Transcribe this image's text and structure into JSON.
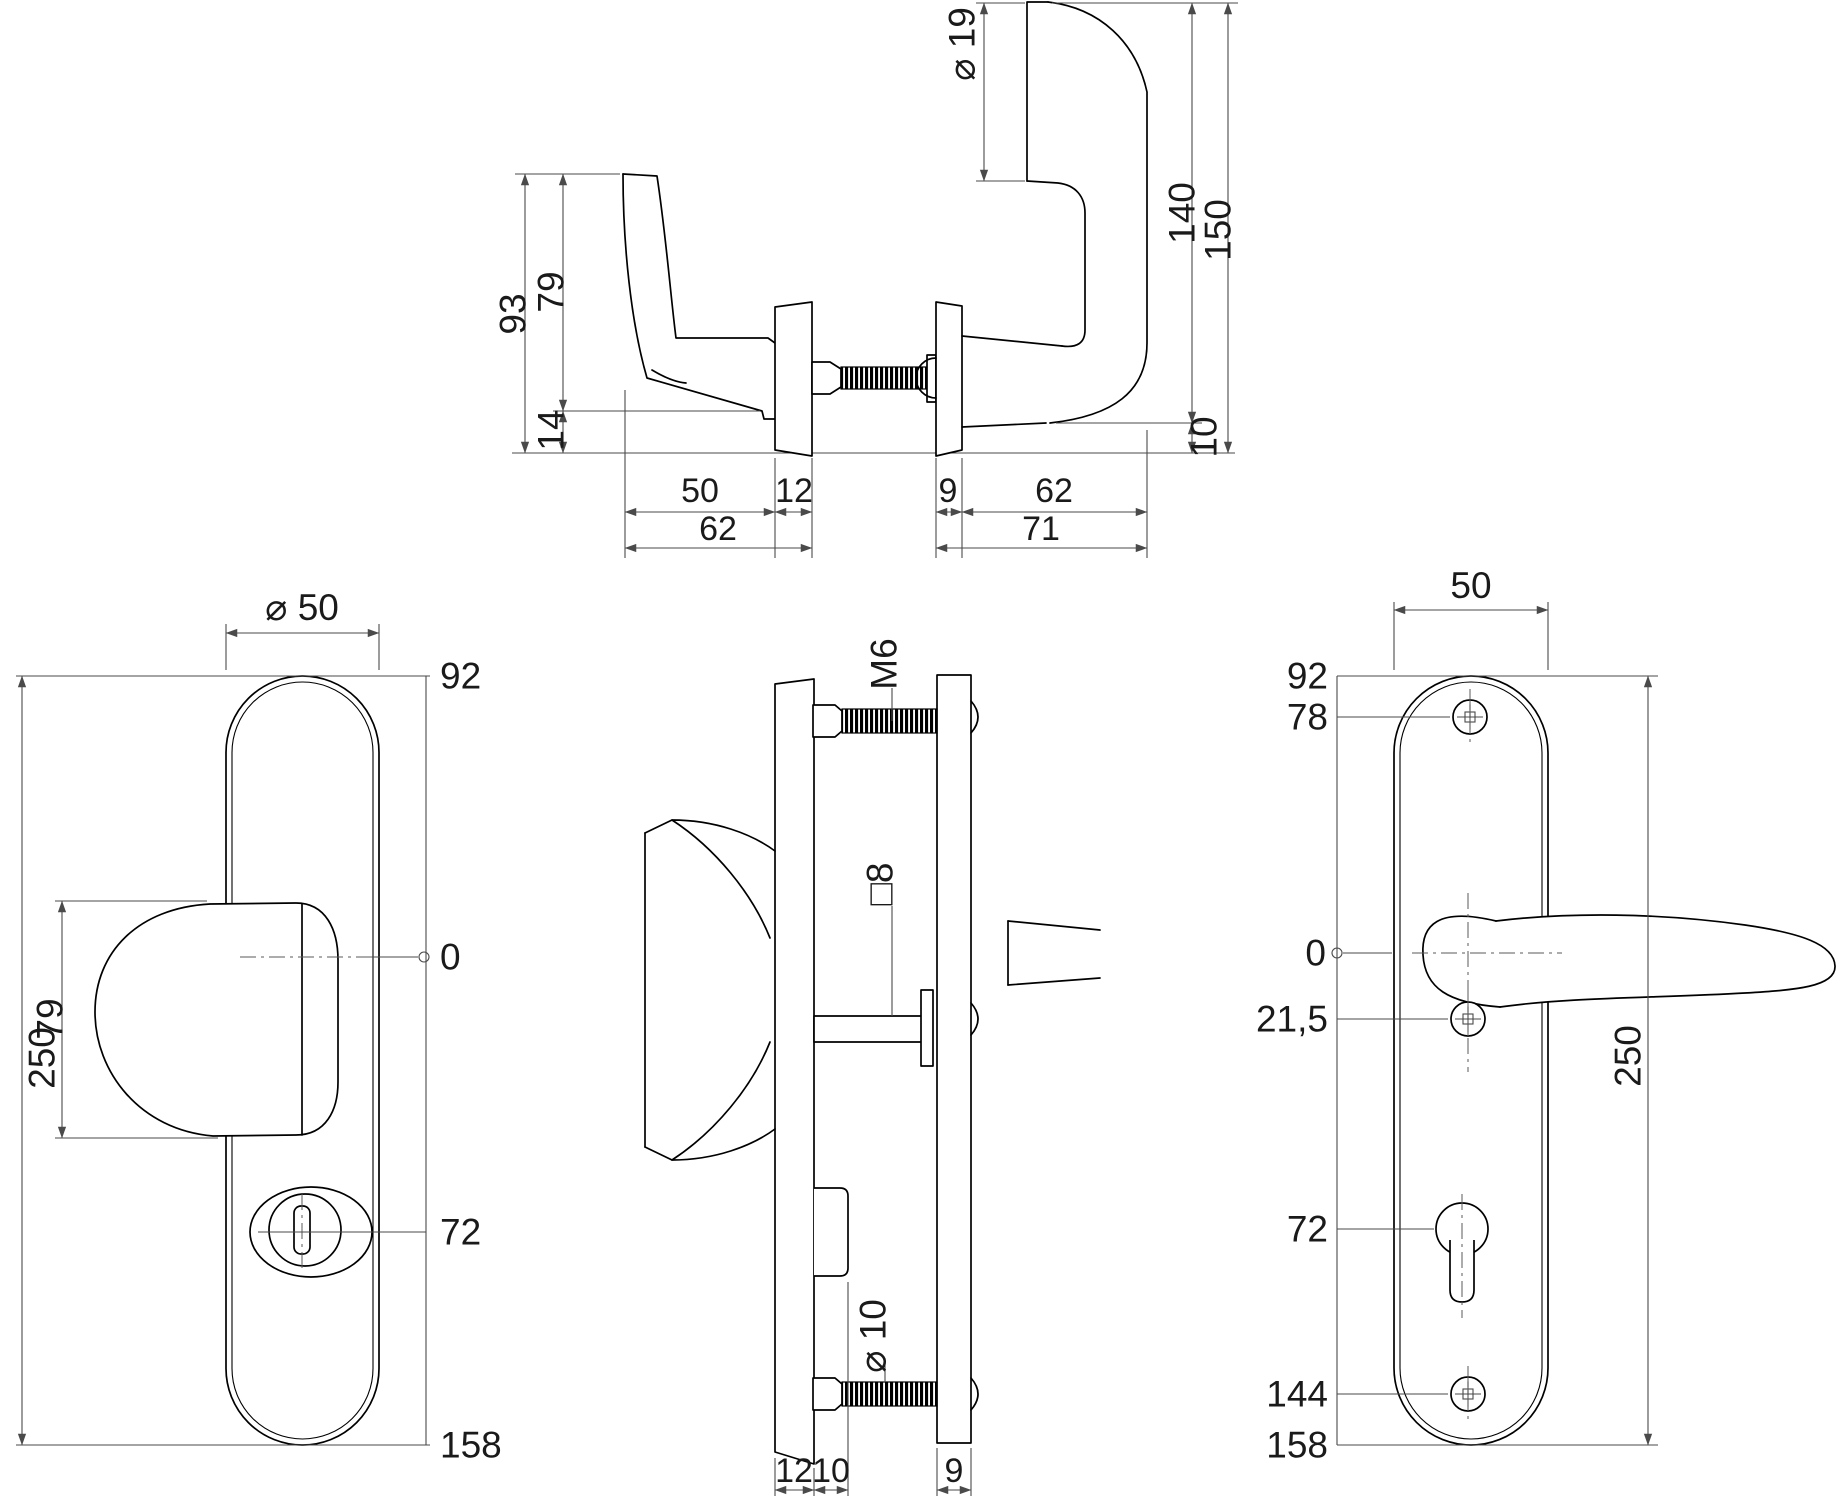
{
  "meta": {
    "background": "#ffffff",
    "line_color": "#000000",
    "dim_color": "#4a4a4a",
    "drawing_type": "security door handle fitting, 4-view dimensioned technical drawing"
  },
  "top_view": {
    "h_total": "93",
    "h_face": "79",
    "h_tip": "14",
    "grip_dia": "⌀ 19",
    "h_inner": "140",
    "h_outer": "150",
    "clearance": "10",
    "knob_face": "50",
    "rose_ext": "12",
    "ext_total": "62",
    "rose_int": "9",
    "projection": "62",
    "int_total": "71"
  },
  "exterior_view": {
    "rose_dia": "⌀ 50",
    "top": "92",
    "knob_h": "79",
    "plate_len": "250",
    "zero": "0",
    "cyl": "72",
    "bottom": "158"
  },
  "section_view": {
    "bolt": "M6",
    "spindle": "□8",
    "screw": "⌀ 10",
    "t_ext": "12",
    "t_guard": "10",
    "t_int": "9"
  },
  "interior_view": {
    "width": "50",
    "top": "92",
    "s_top": "78",
    "zero": "0",
    "s_mid": "21,5",
    "cyl": "72",
    "s_bot": "144",
    "bottom": "158",
    "plate_len": "250"
  }
}
